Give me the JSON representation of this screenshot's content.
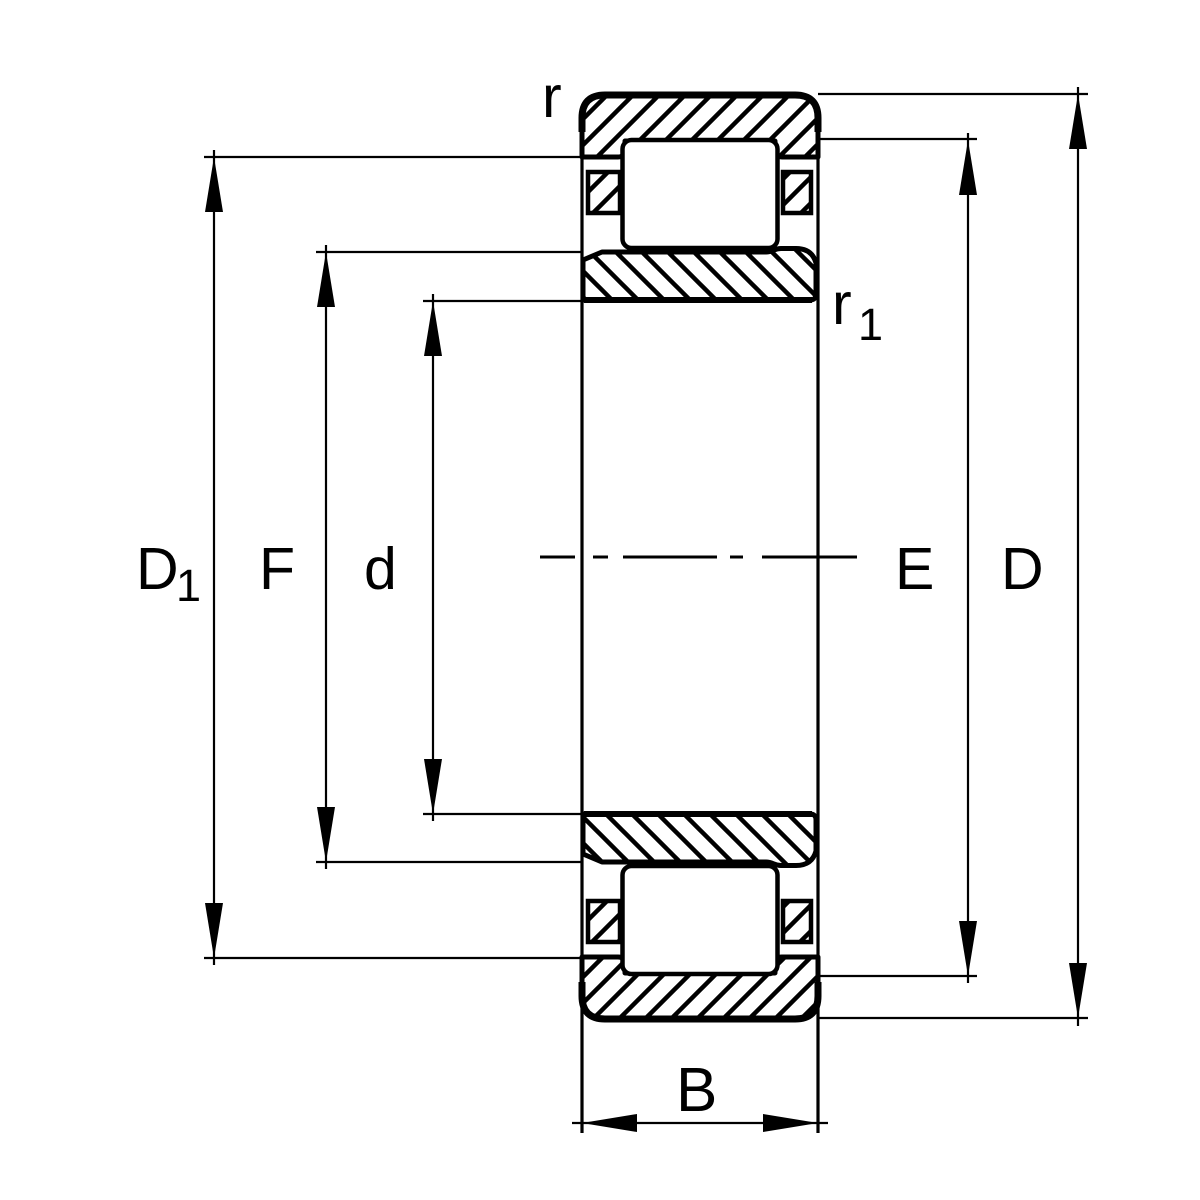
{
  "diagram": {
    "title": "Cylindrical roller bearing cross-section dimension drawing",
    "background_color": "#ffffff",
    "line_color": "#000000",
    "labels": {
      "D1": {
        "main": "D",
        "sub": "1"
      },
      "F": {
        "main": "F"
      },
      "d": {
        "main": "d"
      },
      "E": {
        "main": "E"
      },
      "D": {
        "main": "D"
      },
      "B": {
        "main": "B"
      },
      "r": {
        "main": "r"
      },
      "r1": {
        "main": "r",
        "sub": "1"
      }
    }
  }
}
